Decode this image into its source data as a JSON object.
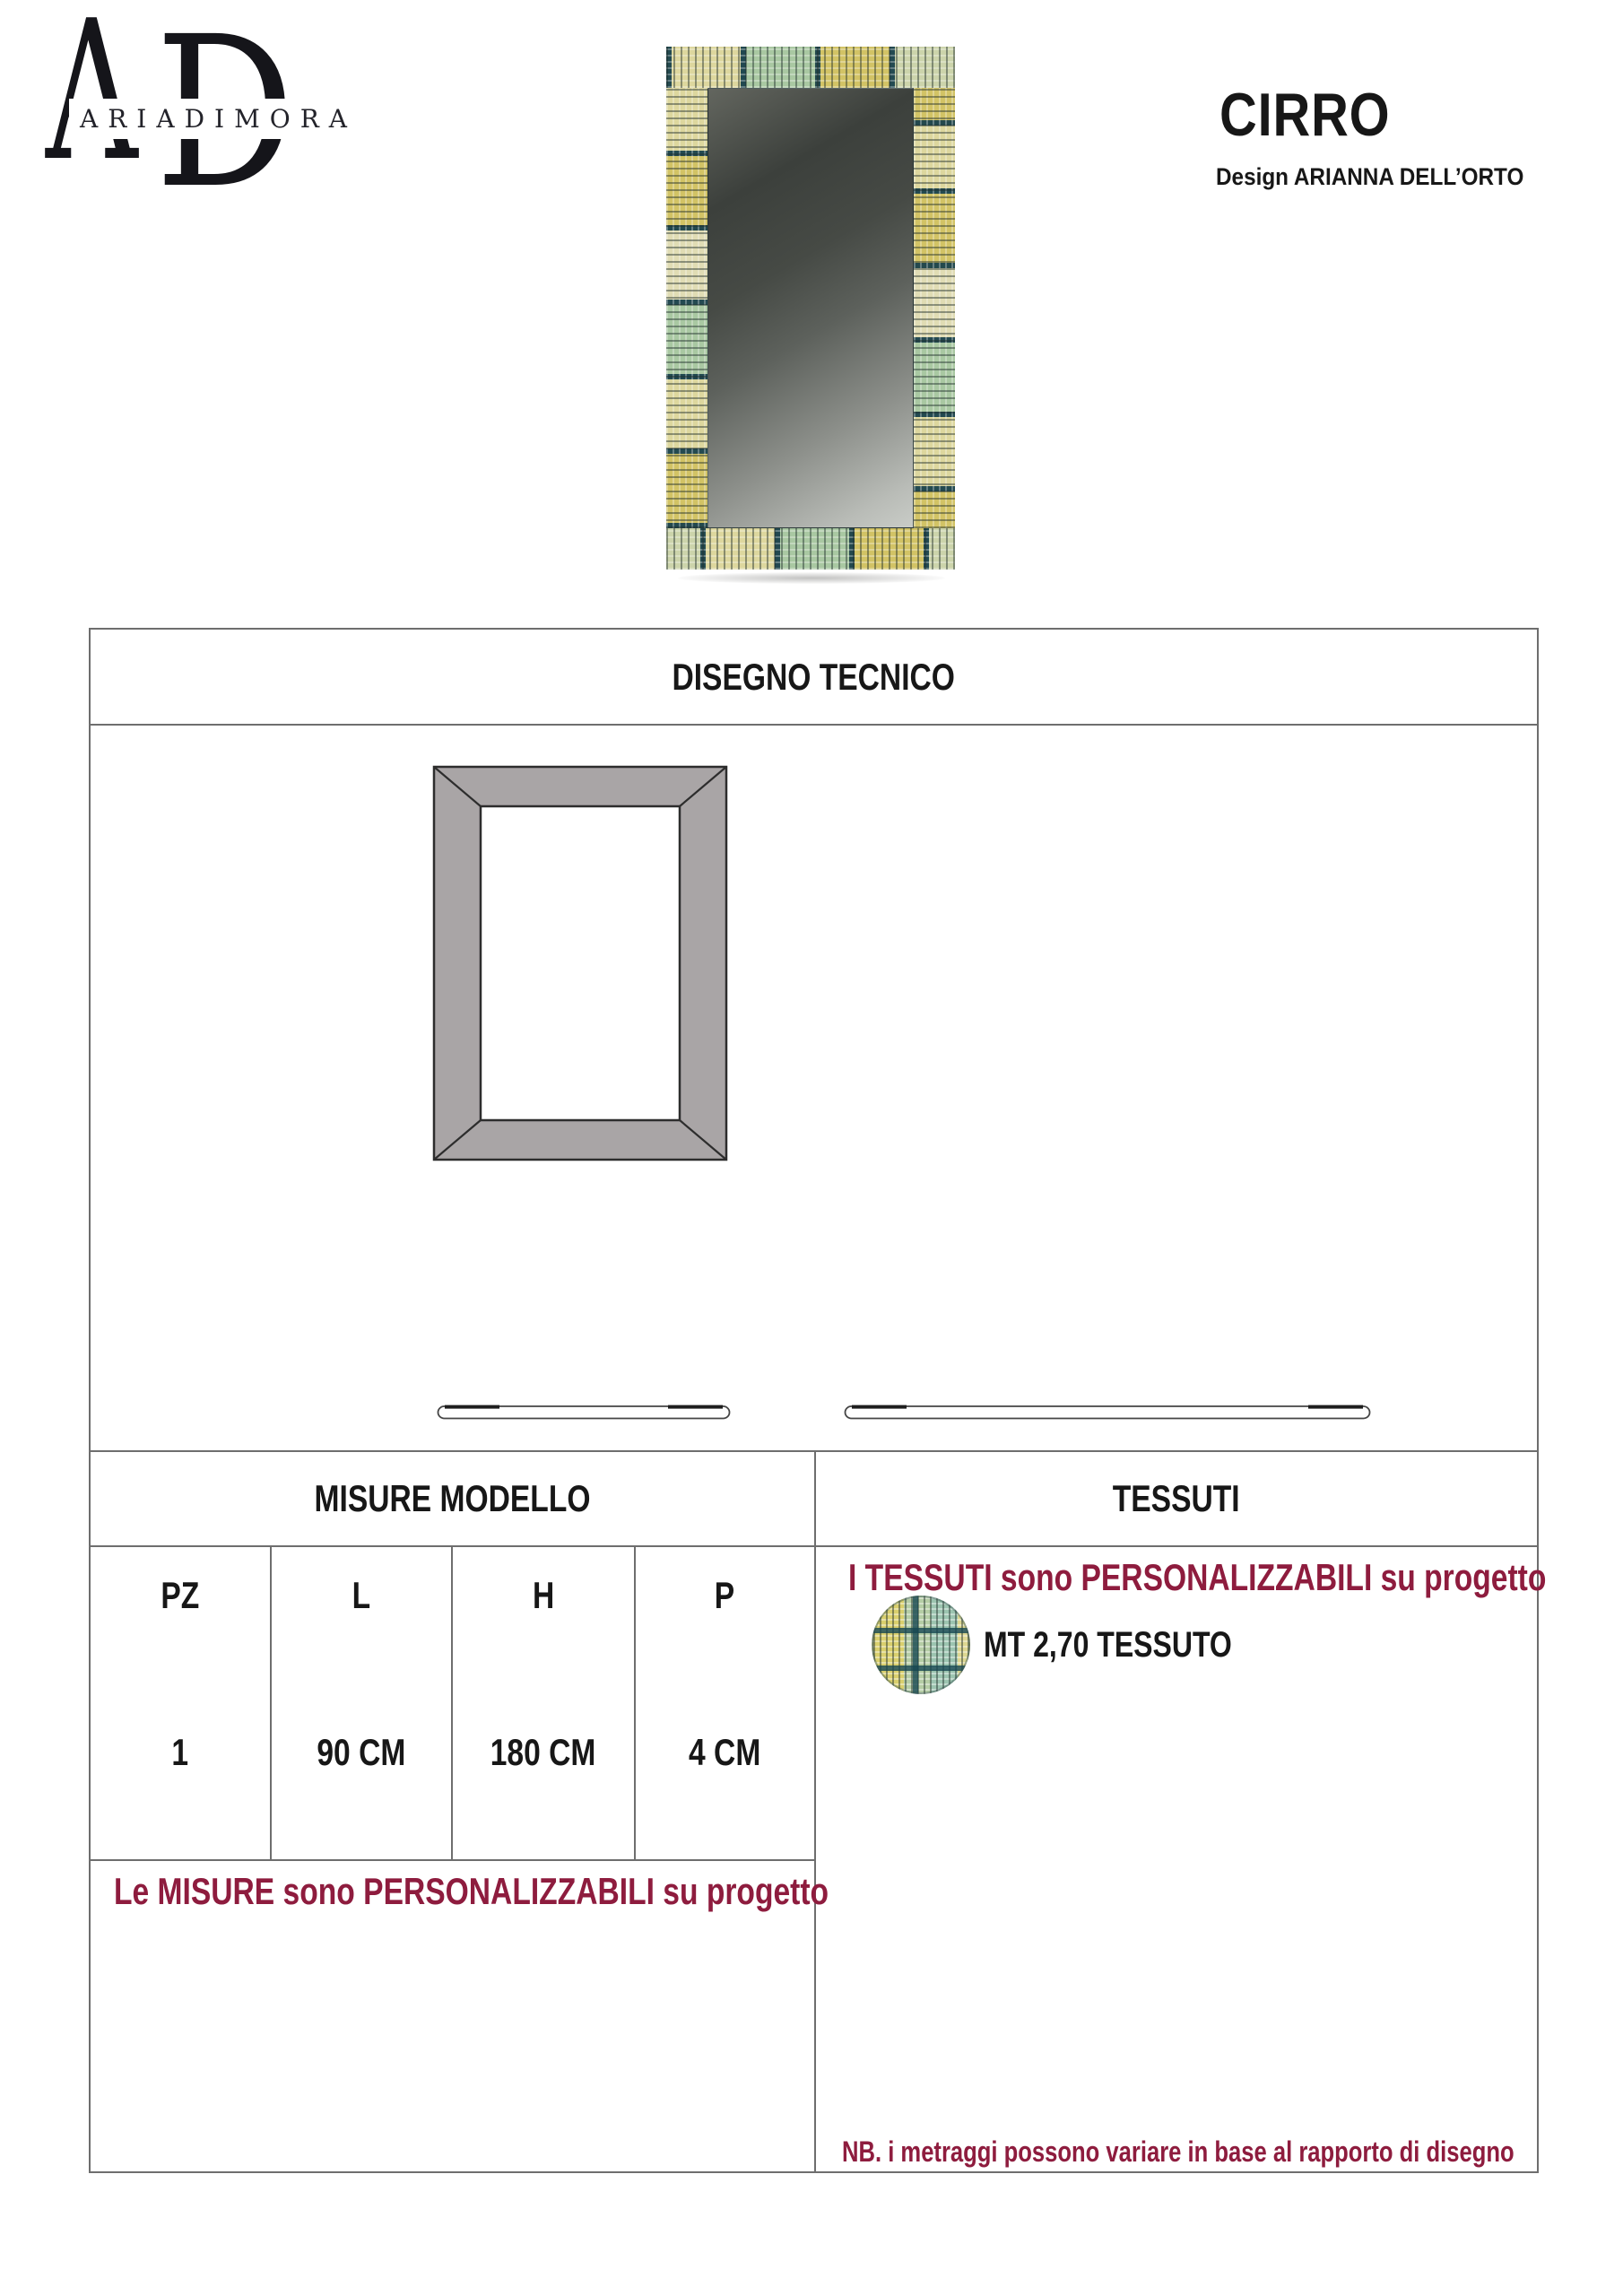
{
  "brand": {
    "monogram_a": "A",
    "monogram_d": "D",
    "wordmark": "ARIADIMORA"
  },
  "product": {
    "name": "CIRRO",
    "designer_line": "Design ARIANNA DELL’ORTO"
  },
  "sections": {
    "technical_drawing_title": "DISEGNO TECNICO",
    "measures_title": "MISURE MODELLO",
    "fabrics_title": "TESSUTI"
  },
  "measures": {
    "headers": [
      "PZ",
      "L",
      "H",
      "P"
    ],
    "row": [
      "1",
      "90 CM",
      "180 CM",
      "4 CM"
    ],
    "note": "Le MISURE sono PERSONALIZZABILI su progetto"
  },
  "fabrics": {
    "note": "I TESSUTI sono PERSONALIZZABILI su progetto",
    "meterage_label": "MT 2,70 TESSUTO",
    "nb_note": "NB. i metraggi possono variare in base al rapporto di disegno",
    "swatch_name": "plaid-yellow-green-teal"
  },
  "colors": {
    "accent_maroon": "#8e1c3e",
    "table_border": "#6e6e6e",
    "drawing_gray": "#a9a5a6",
    "fabric_dark_teal": "#1a424c",
    "fabric_gold": "#d2c365",
    "fabric_sage": "#a9c8a2",
    "fabric_cream": "#ddd79e"
  }
}
